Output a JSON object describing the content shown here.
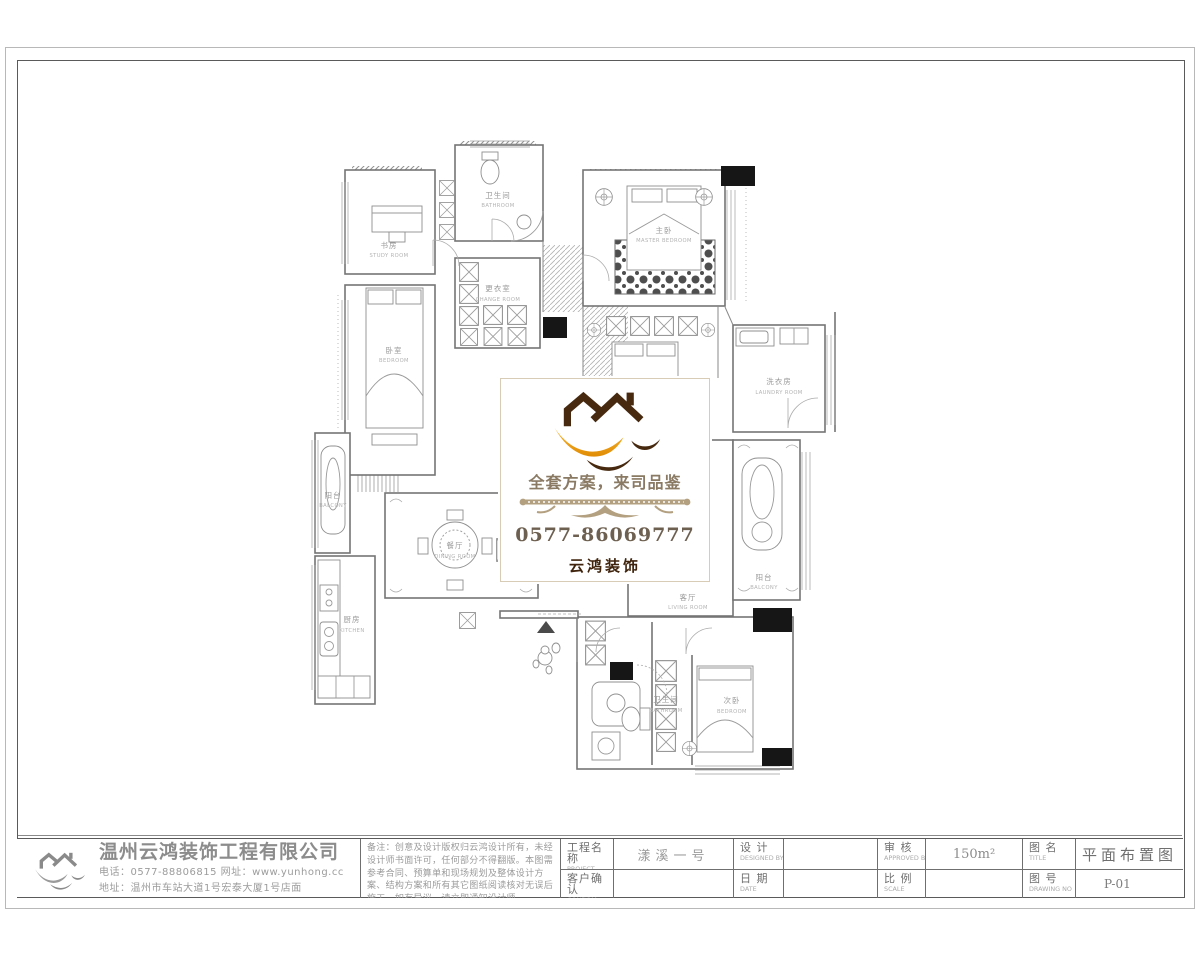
{
  "watermark": {
    "slogan": "全套方案，来司品鉴",
    "phone": "0577-86069777",
    "brand": "云鸿装饰",
    "colors": {
      "roof_brown": "#46290f",
      "swoosh_orange": "#f2a51e",
      "slogan_brown": "#8a7a64",
      "phone_brown": "#6e6050",
      "brand_brown": "#3f230c",
      "ornament_tan": "#b3a080",
      "border_tan": "#d8ccb6"
    }
  },
  "plan": {
    "rooms": [
      {
        "id": "study",
        "cn": "书房",
        "en": "STUDY ROOM"
      },
      {
        "id": "bath-top",
        "cn": "卫生间",
        "en": "BATHROOM"
      },
      {
        "id": "master-bedroom",
        "cn": "主卧",
        "en": "MASTER BEDROOM"
      },
      {
        "id": "bedroom-left",
        "cn": "卧室",
        "en": "BEDROOM"
      },
      {
        "id": "change-room",
        "cn": "更衣室",
        "en": "CHANGE ROOM"
      },
      {
        "id": "laundry",
        "cn": "洗衣房",
        "en": "LAUNDRY ROOM"
      },
      {
        "id": "dining",
        "cn": "餐厅",
        "en": "DINING ROOM"
      },
      {
        "id": "kitchen",
        "cn": "厨房",
        "en": "KITCHEN"
      },
      {
        "id": "living",
        "cn": "客厅",
        "en": "LIVING ROOM"
      },
      {
        "id": "bedroom-second",
        "cn": "次卧",
        "en": "BEDROOM"
      },
      {
        "id": "bath-bottom",
        "cn": "卫生间",
        "en": "BATHROOM"
      },
      {
        "id": "balcony-left",
        "cn": "阳台",
        "en": "BALCONY"
      },
      {
        "id": "balcony-right",
        "cn": "阳台",
        "en": "BALCONY"
      }
    ]
  },
  "titleblock": {
    "company": {
      "name": "温州云鸿装饰工程有限公司",
      "contact_line1": "电话：0577-88806815 网址：www.yunhong.cc",
      "contact_line2": "地址：温州市车站大道1号宏泰大厦1号店面"
    },
    "notes": "备注：创意及设计版权归云鸿设计所有，未经设计师书面许可，任何部分不得翻版。本图需参考合同、预算单和现场规划及整体设计方案、结构方案和所有其它图纸阅读核对无误后施工，如有异议，请立即通知设计师。",
    "fields": {
      "project": {
        "label": "工程名称",
        "sub": "PROJECT",
        "value": "漾溪一号"
      },
      "confirm": {
        "label": "客户确认",
        "sub": "CONFIRM",
        "value": ""
      },
      "designed": {
        "label": "设 计",
        "sub": "DESIGNED BY",
        "value": ""
      },
      "date": {
        "label": "日 期",
        "sub": "DATE",
        "value": ""
      },
      "approved": {
        "label": "审 核",
        "sub": "APPROVED BY",
        "value": "150m²"
      },
      "scale": {
        "label": "比 例",
        "sub": "SCALE",
        "value": ""
      },
      "title": {
        "label": "图 名",
        "sub": "TITLE",
        "value": "平面布置图"
      },
      "number": {
        "label": "图 号",
        "sub": "DRAWING NO",
        "value": "P-01"
      }
    }
  }
}
